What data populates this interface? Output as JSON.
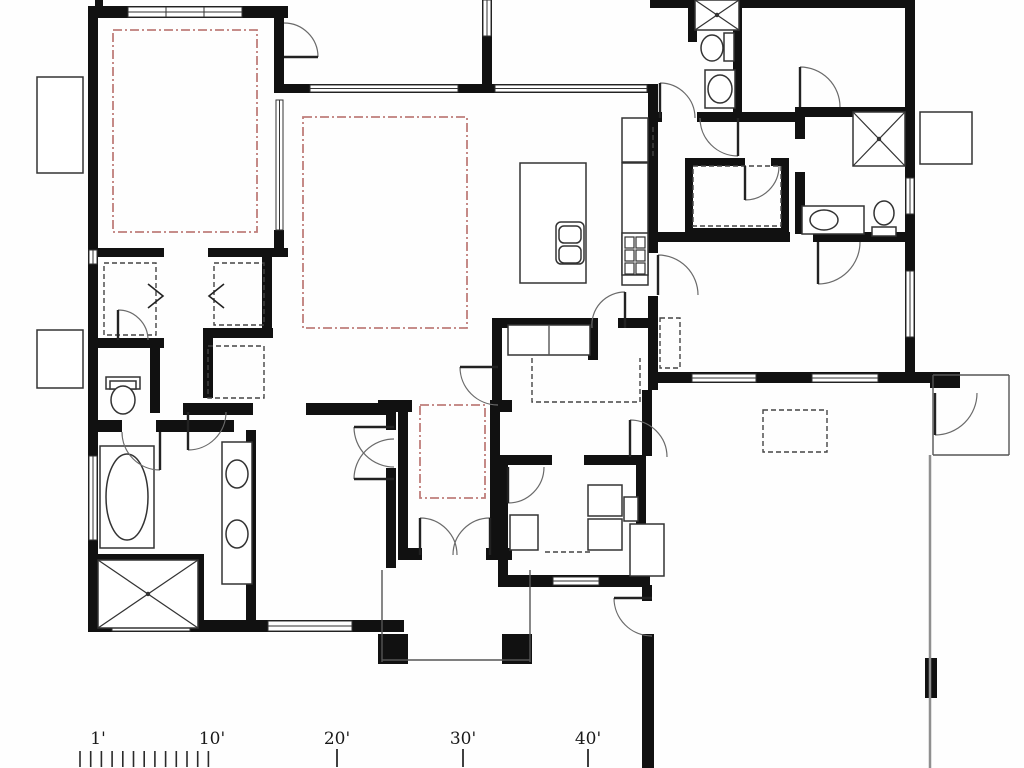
{
  "canvas": {
    "w": 1024,
    "h": 768
  },
  "colors": {
    "wall": "#111111",
    "fixture_line": "#333333",
    "door_arc": "#6a6a6a",
    "door_leaf": "#222222",
    "red_ceiling": "#bf7d7a",
    "dashed_detail": "#444444",
    "property_line": "#8f8f8f",
    "thin_line": "#555555",
    "background": "#fefefe"
  },
  "scale_bar": {
    "labels": [
      {
        "t": "1'",
        "x": 98
      },
      {
        "t": "10'",
        "x": 212
      },
      {
        "t": "20'",
        "x": 337
      },
      {
        "t": "30'",
        "x": 463
      },
      {
        "t": "40'",
        "x": 588
      }
    ],
    "label_y": 744,
    "font_size": 17,
    "minor_ticks": {
      "x_start": 80,
      "spacing": 10.7,
      "count": 13,
      "y1": 751,
      "y2": 767
    },
    "major_tick_xs": [
      337,
      463,
      588
    ],
    "major_y1": 749,
    "major_y2": 767
  },
  "plan": {
    "walls": [
      [
        88,
        6,
        200,
        12
      ],
      [
        88,
        6,
        10,
        626
      ],
      [
        88,
        620,
        316,
        12
      ],
      [
        274,
        18,
        10,
        68
      ],
      [
        274,
        84,
        218,
        9
      ],
      [
        482,
        0,
        10,
        92
      ],
      [
        490,
        84,
        168,
        9
      ],
      [
        648,
        93,
        10,
        160
      ],
      [
        648,
        296,
        10,
        94
      ],
      [
        650,
        0,
        263,
        8
      ],
      [
        905,
        0,
        10,
        382
      ],
      [
        655,
        372,
        275,
        11
      ],
      [
        98,
        248,
        66,
        9
      ],
      [
        208,
        248,
        80,
        9
      ],
      [
        98,
        338,
        66,
        10
      ],
      [
        203,
        328,
        70,
        10
      ],
      [
        150,
        345,
        10,
        68
      ],
      [
        203,
        338,
        10,
        60
      ],
      [
        98,
        420,
        24,
        12
      ],
      [
        156,
        420,
        78,
        12
      ],
      [
        246,
        430,
        10,
        200
      ],
      [
        98,
        554,
        100,
        10
      ],
      [
        194,
        554,
        10,
        76
      ],
      [
        386,
        412,
        10,
        18
      ],
      [
        386,
        468,
        10,
        100
      ],
      [
        183,
        403,
        70,
        12
      ],
      [
        306,
        403,
        82,
        12
      ],
      [
        378,
        400,
        34,
        12
      ],
      [
        490,
        400,
        22,
        12
      ],
      [
        398,
        412,
        10,
        146
      ],
      [
        490,
        412,
        10,
        146
      ],
      [
        398,
        548,
        24,
        12
      ],
      [
        486,
        548,
        26,
        12
      ],
      [
        492,
        318,
        10,
        88
      ],
      [
        498,
        318,
        92,
        10
      ],
      [
        618,
        318,
        40,
        10
      ],
      [
        588,
        318,
        10,
        42
      ],
      [
        498,
        455,
        54,
        10
      ],
      [
        584,
        455,
        62,
        10
      ],
      [
        498,
        455,
        10,
        130
      ],
      [
        636,
        455,
        10,
        132
      ],
      [
        498,
        575,
        152,
        12
      ],
      [
        642,
        585,
        10,
        16
      ],
      [
        642,
        634,
        12,
        134
      ],
      [
        648,
        232,
        142,
        10
      ],
      [
        813,
        232,
        100,
        10
      ],
      [
        733,
        0,
        9,
        112
      ],
      [
        648,
        112,
        14,
        10
      ],
      [
        697,
        112,
        100,
        10
      ],
      [
        795,
        107,
        120,
        10
      ],
      [
        795,
        117,
        10,
        22
      ],
      [
        795,
        172,
        10,
        62
      ],
      [
        685,
        158,
        60,
        8
      ],
      [
        771,
        158,
        18,
        8
      ],
      [
        781,
        158,
        8,
        78
      ],
      [
        685,
        228,
        104,
        8
      ],
      [
        685,
        158,
        8,
        78
      ],
      [
        930,
        372,
        30,
        16
      ],
      [
        688,
        0,
        9,
        42
      ],
      [
        262,
        257,
        10,
        72
      ],
      [
        274,
        230,
        10,
        27
      ],
      [
        642,
        390,
        10,
        66
      ],
      [
        95,
        0,
        8,
        8
      ]
    ],
    "windows": [
      {
        "r": [
          128,
          7,
          114,
          10
        ],
        "o": "h",
        "mullions": [
          166,
          204
        ]
      },
      {
        "r": [
          310,
          85,
          148,
          7
        ],
        "o": "h"
      },
      {
        "r": [
          495,
          85,
          152,
          7
        ],
        "o": "h"
      },
      {
        "r": [
          89,
          456,
          8,
          84
        ],
        "o": "v"
      },
      {
        "r": [
          112,
          621,
          78,
          10
        ],
        "o": "h"
      },
      {
        "r": [
          268,
          621,
          84,
          10
        ],
        "o": "h"
      },
      {
        "r": [
          906,
          178,
          8,
          36
        ],
        "o": "v"
      },
      {
        "r": [
          906,
          271,
          8,
          66
        ],
        "o": "v"
      },
      {
        "r": [
          692,
          374,
          64,
          8
        ],
        "o": "h"
      },
      {
        "r": [
          812,
          374,
          66,
          8
        ],
        "o": "h"
      },
      {
        "r": [
          553,
          577,
          46,
          8
        ],
        "o": "h"
      },
      {
        "r": [
          276,
          100,
          7,
          130
        ],
        "o": "v"
      },
      {
        "r": [
          483,
          0,
          8,
          36
        ],
        "o": "v"
      },
      {
        "r": [
          89,
          250,
          8,
          14
        ],
        "o": "v"
      }
    ],
    "red_ceiling_rects": [
      [
        113,
        30,
        144,
        202
      ],
      [
        303,
        117,
        164,
        211
      ],
      [
        420,
        405,
        65,
        93
      ]
    ],
    "dashed_rects": [
      [
        763,
        410,
        64,
        42
      ],
      [
        104,
        263,
        52,
        72
      ],
      [
        214,
        263,
        50,
        62
      ],
      [
        693,
        166,
        88,
        60
      ],
      [
        208,
        346,
        56,
        52
      ],
      [
        556,
        190,
        26,
        32
      ],
      [
        660,
        318,
        20,
        50
      ]
    ],
    "dashed_polylines": [
      [
        [
          532,
          358
        ],
        [
          532,
          402
        ],
        [
          640,
          402
        ],
        [
          640,
          358
        ]
      ],
      [
        [
          545,
          552
        ],
        [
          592,
          552
        ]
      ],
      [
        [
          653,
          127
        ],
        [
          653,
          157
        ]
      ]
    ],
    "fixture_rects": [
      [
        520,
        163,
        66,
        120
      ],
      [
        622,
        163,
        26,
        122
      ],
      [
        622,
        233,
        26,
        42
      ],
      [
        622,
        118,
        26,
        44
      ],
      [
        100,
        446,
        54,
        102
      ],
      [
        222,
        442,
        30,
        142
      ],
      [
        106,
        377,
        34,
        12
      ],
      [
        110,
        381,
        26,
        8
      ],
      [
        705,
        70,
        30,
        38
      ],
      [
        724,
        33,
        10,
        28
      ],
      [
        802,
        206,
        62,
        28
      ],
      [
        872,
        227,
        24,
        9
      ],
      [
        588,
        485,
        34,
        31
      ],
      [
        588,
        519,
        34,
        31
      ],
      [
        624,
        497,
        14,
        24
      ],
      [
        630,
        524,
        34,
        52
      ],
      [
        920,
        112,
        52,
        52
      ],
      [
        37,
        77,
        46,
        96
      ],
      [
        37,
        330,
        46,
        58
      ],
      [
        508,
        325,
        82,
        30
      ],
      [
        510,
        515,
        28,
        35
      ]
    ],
    "fixture_rounded": [
      [
        556,
        222,
        28,
        42
      ],
      [
        559,
        226,
        22,
        17
      ],
      [
        559,
        246,
        22,
        17
      ]
    ],
    "burners": [
      [
        625,
        237,
        9,
        11
      ],
      [
        636,
        237,
        9,
        11
      ],
      [
        625,
        250,
        9,
        11
      ],
      [
        636,
        250,
        9,
        11
      ],
      [
        625,
        263,
        9,
        11
      ],
      [
        636,
        263,
        9,
        11
      ]
    ],
    "ellipses": [
      [
        127,
        497,
        21,
        43
      ],
      [
        237,
        474,
        11,
        14
      ],
      [
        237,
        534,
        11,
        14
      ],
      [
        123,
        400,
        12,
        14
      ],
      [
        712,
        48,
        11,
        13
      ],
      [
        720,
        89,
        12,
        14
      ],
      [
        824,
        220,
        14,
        10
      ],
      [
        884,
        213,
        10,
        12
      ]
    ],
    "showers": [
      [
        98,
        560,
        100,
        68
      ],
      [
        695,
        0,
        44,
        30
      ],
      [
        853,
        112,
        52,
        54
      ]
    ],
    "black_squares": [
      [
        378,
        634,
        30,
        30
      ],
      [
        502,
        634,
        30,
        30
      ],
      [
        925,
        658,
        12,
        40
      ]
    ],
    "door_arcs": [
      {
        "d": "M318,57 A34,34 0 0 0 284,23",
        "leaf": [
          284,
          57,
          318,
          57
        ]
      },
      {
        "d": "M354,427 A40,40 0 0 0 394,467",
        "leaf": [
          354,
          427,
          394,
          427
        ]
      },
      {
        "d": "M354,479 A40,40 0 0 1 394,439",
        "leaf": [
          354,
          479,
          394,
          479
        ]
      },
      {
        "d": "M420,518 A37,37 0 0 1 457,555",
        "leaf": [
          420,
          518,
          420,
          555
        ]
      },
      {
        "d": "M490,518 A37,37 0 0 0 453,555",
        "leaf": [
          490,
          518,
          490,
          555
        ]
      },
      {
        "d": "M122,432 A38,38 0 0 0 160,470",
        "leaf": [
          160,
          432,
          160,
          470
        ]
      },
      {
        "d": "M188,450 A38,38 0 0 0 226,412",
        "leaf": [
          188,
          412,
          188,
          450
        ]
      },
      {
        "d": "M660,83 A35,35 0 0 1 695,118",
        "leaf": [
          660,
          83,
          660,
          118
        ]
      },
      {
        "d": "M800,67 A40,40 0 0 1 840,107",
        "leaf": [
          800,
          67,
          800,
          107
        ]
      },
      {
        "d": "M700,118 A38,38 0 0 0 738,156",
        "leaf": [
          738,
          118,
          738,
          156
        ]
      },
      {
        "d": "M745,200 A34,34 0 0 0 779,166",
        "leaf": [
          745,
          166,
          745,
          200
        ]
      },
      {
        "d": "M818,284 A42,42 0 0 0 860,242",
        "leaf": [
          818,
          242,
          818,
          284
        ]
      },
      {
        "d": "M658,255 A40,40 0 0 1 698,295",
        "leaf": [
          658,
          255,
          658,
          295
        ]
      },
      {
        "d": "M625,292 A33,33 0 0 0 592,328",
        "leaf": [
          625,
          292,
          625,
          328
        ]
      },
      {
        "d": "M460,367 A38,38 0 0 0 498,405",
        "leaf": [
          460,
          367,
          498,
          367
        ]
      },
      {
        "d": "M508,503 A36,36 0 0 0 544,467",
        "leaf": [
          508,
          467,
          508,
          503
        ]
      },
      {
        "d": "M630,420 A37,37 0 0 1 667,457",
        "leaf": [
          630,
          420,
          630,
          457
        ]
      },
      {
        "d": "M614,598 A38,38 0 0 0 652,636",
        "leaf": [
          652,
          598,
          614,
          598
        ]
      },
      {
        "d": "M935,435 A42,42 0 0 0 977,393",
        "leaf": [
          935,
          393,
          935,
          435
        ]
      },
      {
        "d": "M118,310 A30,30 0 0 1 148,340",
        "leaf": [
          118,
          310,
          118,
          340
        ]
      }
    ],
    "zigzags": [
      [
        [
          148,
          284
        ],
        [
          163,
          296
        ],
        [
          148,
          308
        ]
      ],
      [
        [
          224,
          284
        ],
        [
          209,
          296
        ],
        [
          224,
          308
        ]
      ]
    ],
    "thin_lines": [
      [
        382,
        570,
        382,
        662
      ],
      [
        530,
        570,
        530,
        662
      ],
      [
        382,
        660,
        530,
        660
      ],
      [
        933,
        375,
        1009,
        375
      ],
      [
        1009,
        375,
        1009,
        455
      ],
      [
        933,
        455,
        1009,
        455
      ],
      [
        933,
        375,
        933,
        455
      ],
      [
        549,
        325,
        549,
        355
      ]
    ],
    "property_lines": [
      [
        930,
        455,
        930,
        768
      ]
    ]
  }
}
